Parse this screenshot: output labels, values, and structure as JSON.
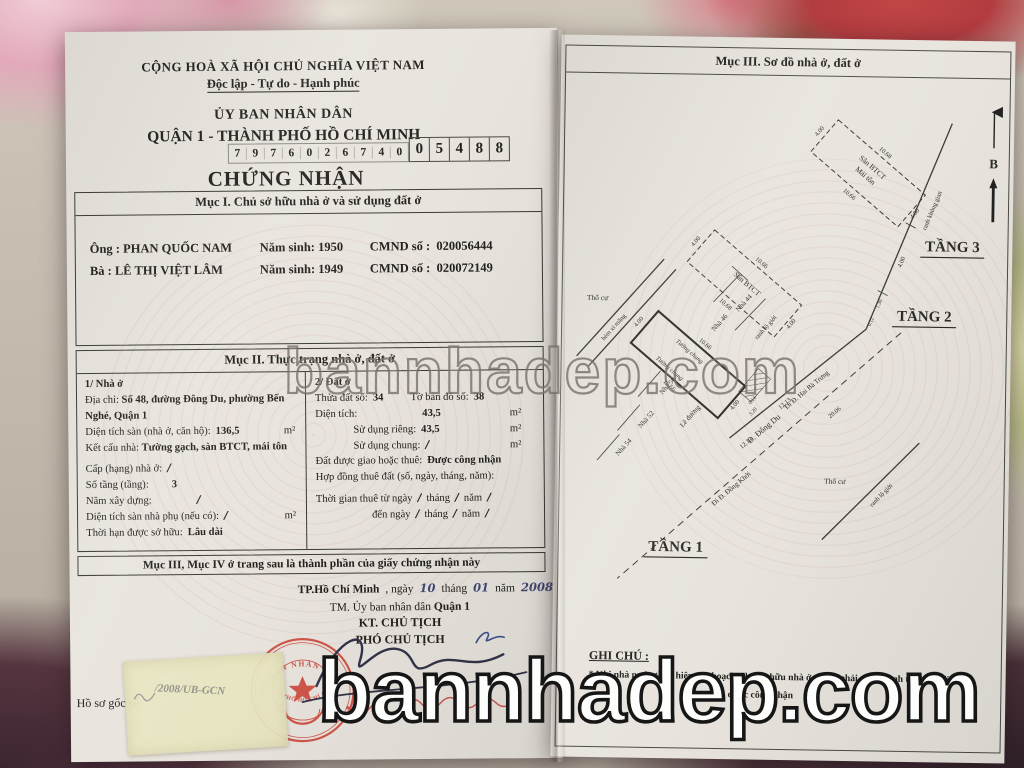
{
  "photo": {
    "watermark": "bannhadep.com"
  },
  "left_page": {
    "header": {
      "motto1": "CỘNG HOÀ XÃ HỘI CHỦ NGHĨA VIỆT NAM",
      "motto2": "Độc lập - Tự do - Hạnh phúc",
      "issuer": "ỦY BAN NHÂN DÂN",
      "district": "QUẬN 1 - THÀNH PHỐ HỒ CHÍ MINH",
      "serial": [
        "7",
        "9",
        "7",
        "6",
        "0",
        "2",
        "6",
        "7",
        "4",
        "0",
        "0",
        "5",
        "4",
        "8",
        "8"
      ],
      "title": "CHỨNG NHẬN"
    },
    "section1": {
      "heading": "Mục I. Chủ sở hữu nhà ở và sử dụng đất ở",
      "owner1_prefix": "Ông :",
      "owner1_name": "PHAN QUỐC NAM",
      "owner1_birth_label": "Năm sinh: 1950",
      "owner1_id_label": "CMND số :",
      "owner1_id": "020056444",
      "owner2_prefix": "Bà :",
      "owner2_name": "LÊ THỊ VIỆT LÂM",
      "owner2_birth_label": "Năm sinh: 1949",
      "owner2_id_label": "CMND số :",
      "owner2_id": "020072149"
    },
    "section2": {
      "heading": "Mục II. Thực trạng nhà ở, đất ở",
      "house": {
        "title": "1/ Nhà ở",
        "address_label": "Địa chỉ:",
        "address": "Số 48, đường Đông Du, phường Bến Nghé, Quận 1",
        "floor_area_label": "Diện tích sàn (nhà ở, căn hộ):",
        "floor_area": "136,5",
        "structure_label": "Kết cấu nhà:",
        "structure": "Tường gạch, sàn BTCT, mái tôn",
        "grade_label": "Cấp (hạng) nhà ở:",
        "grade": "/",
        "floors_label": "Số tầng (tầng):",
        "floors": "3",
        "year_label": "Năm xây dựng:",
        "year_built": "/",
        "aux_label": "Diện tích sàn nhà phụ (nếu có):",
        "aux": "/",
        "tenure_label": "Thời hạn được sở hữu:",
        "tenure": "Lâu dài",
        "sqm": "m²"
      },
      "land": {
        "title": "2/ Đất ở",
        "parcel_label": "Thửa đất số:",
        "parcel": "34",
        "map_label": "Tờ bản đồ số:",
        "map": "38",
        "area_label": "Diện tích:",
        "area": "43,5",
        "private_label": "Sử dụng riêng:",
        "private_use": "43,5",
        "shared_label": "Sử dụng chung:",
        "shared": "/",
        "grant_label": "Đất được giao hoặc thuê:",
        "grant": "Được công nhận",
        "contract_label": "Hợp đồng thuê đất (số, ngày, tháng, năm):",
        "lease_from": "Thời gian thuê từ ngày",
        "lease_to": "đến ngày",
        "thang": "tháng",
        "nam": "năm",
        "slash": "/",
        "sqm": "m²"
      }
    },
    "section3_note": "Mục III, Mục IV ở trang sau là thành phần của giấy chứng nhận này",
    "signing": {
      "place": "TP.Hồ Chí Minh",
      "comma_ngay": ", ngày",
      "day": "10",
      "thang": "tháng",
      "month": "01",
      "nam": "năm",
      "year": "2008",
      "on_behalf": "TM. Ủy ban nhân dân",
      "on_behalf_bold": "Quận 1",
      "title1": "KT. CHỦ TỊCH",
      "title2": "PHÓ CHỦ TỊCH",
      "stamp_top": "ỦY BAN NHÂN DÂN",
      "stamp_bottom": "THÀNH PHỐ HỒ CHÍ MINH"
    },
    "footer": {
      "label": "Hồ sơ gốc số",
      "sticker": "/2008/UB-GCN"
    }
  },
  "right_page": {
    "heading": "Mục III. Sơ đồ nhà ở, đất ở",
    "compass": "B",
    "floors": {
      "t1": "TẦNG 1",
      "t2": "TẦNG 2",
      "t3": "TẦNG 3"
    },
    "labels": {
      "san_btct": "Sân BTCT",
      "mai_ton": "Mái tôn",
      "tho_cu": "Thổ cư",
      "tuong_chung": "Tường chung",
      "hem": "hẻm xi măng",
      "nha44": "Nhà 44",
      "nha46": "Nhà 46",
      "nha50": "Nhà 50",
      "nha52": "Nhà 52",
      "nha54": "Nhà 54",
      "le_duong": "Lề đường",
      "street": "Đ. Đông Du",
      "to_hai_ba_trung": "Đi Đ. Hai Bà Trưng",
      "to_dong_khoi": "Đi Đ. Đồng Khởi",
      "ranh_lo_gioi": "ranh lộ giới",
      "ranh_khong_gian": "ranh không gian"
    },
    "dims": {
      "d400": "4.00",
      "d1066": "10.66",
      "d1068": "10.68",
      "d1213": "12.13",
      "d2006": "20.06",
      "d014": "0.14",
      "d320": "3.20",
      "d130": "1.30",
      "d012": "0.12"
    },
    "notes": {
      "heading": "GHI CHÚ :",
      "line1": "* Khi nhà nước thực hiện qui hoạch, chủ sở hữu nhà ở, đất ở phải chấp hành theo qui định.",
      "line2": "* … được công nhận"
    }
  },
  "colors": {
    "stamp_red": "#c8443a",
    "ink": "#22211e",
    "paper": "#e8e4dd",
    "hand_blue": "#414a74"
  }
}
